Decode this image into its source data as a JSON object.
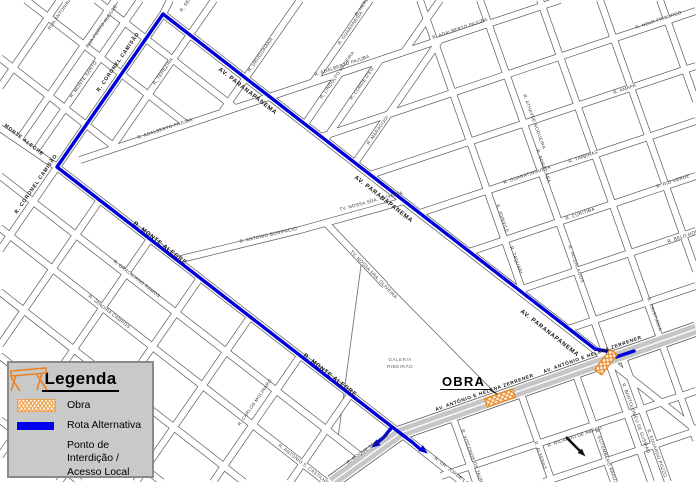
{
  "legend": {
    "title": "Legenda",
    "items": [
      {
        "id": "obra",
        "label": "Obra"
      },
      {
        "id": "rota",
        "label": "Rota Alternativa"
      },
      {
        "id": "ponto",
        "label": "Ponto de Interdição /",
        "label2": "Acesso Local"
      }
    ]
  },
  "map": {
    "colors": {
      "background": "#ffffff",
      "road_casing": "#5a5a5a",
      "road_fill": "#ffffff",
      "avenue_fill": "#c6c6c6",
      "route_blue": "#0000dd",
      "obra_orange": "#e8841f",
      "label_dark": "#3a3a3a",
      "label_main": "#111111",
      "creek_gray": "#777777"
    },
    "obra_callout": "OBRA",
    "galeria_label_line1": "GALERIA",
    "galeria_label_line2": "RIBEIRÃO",
    "roads": [
      {
        "name": "r-coronel-camisao",
        "pts": "170,0 163,14 57,167 0,250"
      },
      {
        "name": "av-paranapanema",
        "pts": "163,14 608,360 696,430"
      },
      {
        "name": "r-monte-alegre",
        "pts": "0,128 57,167 400,433 462,482"
      },
      {
        "name": "r-terezina",
        "pts": "214,0 110,150"
      },
      {
        "name": "r-adalberto-pajuba",
        "pts": "80,160 560,0"
      },
      {
        "name": "street",
        "pts": "115,0 20,138"
      },
      {
        "name": "street",
        "pts": "60,0 0,87"
      },
      {
        "name": "street",
        "pts": "140,0 36,150"
      },
      {
        "name": "street",
        "pts": "300,0 222,112"
      },
      {
        "name": "street",
        "pts": "370,0 313,82"
      },
      {
        "name": "street",
        "pts": "440,0 404,52"
      },
      {
        "name": "street",
        "pts": "340,73 305,124"
      },
      {
        "name": "street",
        "pts": "380,60 325,140"
      },
      {
        "name": "street",
        "pts": "440,40 355,163"
      },
      {
        "name": "street",
        "pts": "0,58 116,148"
      },
      {
        "name": "street",
        "pts": "26,0 186,124"
      },
      {
        "name": "street",
        "pts": "96,0 235,108"
      },
      {
        "name": "street",
        "pts": "177,260 300,230 404,201"
      },
      {
        "name": "street",
        "pts": "325,222 385,285"
      },
      {
        "name": "street",
        "pts": "0,176 363,458"
      },
      {
        "name": "street",
        "pts": "0,228 326,482"
      },
      {
        "name": "street",
        "pts": "0,292 244,482"
      },
      {
        "name": "street",
        "pts": "0,356 162,482"
      },
      {
        "name": "street",
        "pts": "0,420 80,482"
      },
      {
        "name": "street",
        "pts": "100,200 0,345"
      },
      {
        "name": "street",
        "pts": "150,239 0,456"
      },
      {
        "name": "street",
        "pts": "200,278 59,482"
      },
      {
        "name": "street",
        "pts": "250,317 136,482"
      },
      {
        "name": "street",
        "pts": "300,356 213,482"
      },
      {
        "name": "street",
        "pts": "350,395 290,482"
      },
      {
        "name": "street",
        "pts": "321,137 696,11"
      },
      {
        "name": "street",
        "pts": "370,175 696,66"
      },
      {
        "name": "street",
        "pts": "420,213 696,121"
      },
      {
        "name": "street",
        "pts": "469,252 696,176"
      },
      {
        "name": "street",
        "pts": "519,290 696,231"
      },
      {
        "name": "street",
        "pts": "568,329 696,286"
      },
      {
        "name": "street",
        "pts": "441,476 696,391"
      },
      {
        "name": "street",
        "pts": "544,482 696,431"
      },
      {
        "name": "street",
        "pts": "420,0 524,295"
      },
      {
        "name": "street",
        "pts": "480,0 608,360 651,482"
      },
      {
        "name": "street",
        "pts": "540,0 661,341 696,440"
      },
      {
        "name": "street",
        "pts": "600,0 696,271"
      },
      {
        "name": "street",
        "pts": "660,0 696,101"
      },
      {
        "name": "street",
        "pts": "520,391 552,482"
      },
      {
        "name": "street",
        "pts": "452,415 476,482"
      },
      {
        "name": "street",
        "pts": "575,372 614,482"
      },
      {
        "name": "street",
        "pts": "622,355 668,482"
      }
    ],
    "avenue": {
      "name": "av-antonio-e-helena-zerrener",
      "pts": "332,482 400,433 696,329"
    },
    "creeks": [
      "362,258 338,438",
      "362,258 500,398"
    ],
    "route": {
      "main": "634,351 616,357 606,351 595,349 163,14 57,167 400,433 412,442 420,449",
      "branch": "392,427 384,437 377,443",
      "arrows": [
        {
          "x": 427,
          "y": 453,
          "a": 38
        },
        {
          "x": 372,
          "y": 447,
          "a": 144
        }
      ]
    },
    "obra_zones": [
      {
        "cx": 500,
        "cy": 398,
        "w": 30,
        "h": 9,
        "a": -19.4
      },
      {
        "cx": 606,
        "cy": 362,
        "w": 9,
        "h": 26,
        "a": 37.8
      }
    ],
    "obra_callout_pos": {
      "x": 442,
      "y": 386,
      "underline": "440,389.5 490,389.5 497,394"
    },
    "galeria_pos": {
      "x": 400,
      "y": 361
    },
    "pointer": {
      "line": "566,437 581,452",
      "tip": {
        "x": 584,
        "y": 455,
        "a": 45
      }
    },
    "labels": [
      {
        "t": "RUA ANTONINA",
        "x": 50,
        "y": 30,
        "r": -55,
        "s": 4.6
      },
      {
        "t": "RUA PORTO ALEGRE",
        "x": 88,
        "y": 48,
        "r": -55,
        "s": 4.6
      },
      {
        "t": "R. MONTE SANTO",
        "x": 72,
        "y": 98,
        "r": -55,
        "s": 4.6
      },
      {
        "t": "R. TEREZINA",
        "x": 155,
        "y": 85,
        "r": -55,
        "s": 4.6
      },
      {
        "t": "R. SERGIPE",
        "x": 182,
        "y": 12,
        "r": -55,
        "s": 4.6
      },
      {
        "t": "R. GUARANESIA",
        "x": 340,
        "y": 45,
        "r": -55,
        "s": 4.6
      },
      {
        "t": "R. HERESINA",
        "x": 357,
        "y": 16,
        "r": -55,
        "s": 4.6
      },
      {
        "t": "R. URUGUAIANA",
        "x": 250,
        "y": 72,
        "r": -55,
        "s": 4.6
      },
      {
        "t": "R. LINDOLFO MADEIRA",
        "x": 322,
        "y": 99,
        "r": -55,
        "s": 4.6
      },
      {
        "t": "R. CONDE D'EU",
        "x": 352,
        "y": 100,
        "r": -55,
        "s": 4.6
      },
      {
        "t": "R. MARAGOGI",
        "x": 369,
        "y": 145,
        "r": -55,
        "s": 4.6
      },
      {
        "t": "R. ADALBERTO PAJUBA",
        "x": 138,
        "y": 139,
        "r": -18.5,
        "s": 4.6
      },
      {
        "t": "R. ADALBERTO PAJUBA",
        "x": 315,
        "y": 76,
        "r": -18.5,
        "s": 4.6
      },
      {
        "t": "R. ADALBERTO PAJUBA",
        "x": 433,
        "y": 39,
        "r": -18.5,
        "s": 4.6
      },
      {
        "t": "R. ANTONIO BONIFACIO",
        "x": 240,
        "y": 243,
        "r": -13,
        "s": 4.6
      },
      {
        "t": "TV. NOSSA SRA. OLIVEIRA",
        "x": 340,
        "y": 211,
        "r": -15,
        "s": 4.6
      },
      {
        "t": "TV. NOSSA SRA. OLIVEIRA",
        "x": 350,
        "y": 252,
        "r": 46,
        "s": 4.6
      },
      {
        "t": "R. GRACILIANO RAMOS",
        "x": 113,
        "y": 262,
        "r": 38,
        "s": 4.6
      },
      {
        "t": "R. JANDIRA CAMPOS",
        "x": 88,
        "y": 297,
        "r": 38,
        "s": 4.6
      },
      {
        "t": "R. ANTONIO S. CASTILHO",
        "x": 278,
        "y": 446,
        "r": 38,
        "s": 4.6
      },
      {
        "t": "R. CARLOS MOLINARO",
        "x": 240,
        "y": 426,
        "r": -55,
        "s": 4.6
      },
      {
        "t": "R. ROQUE TAGLIARI",
        "x": 348,
        "y": 464,
        "r": -35,
        "s": 4.6
      },
      {
        "t": "R. DR. JORGE LOBATO",
        "x": 434,
        "y": 459,
        "r": 38,
        "s": 4.6
      },
      {
        "t": "R. VISCONDE DE TAUNAY",
        "x": 461,
        "y": 430,
        "r": 70,
        "s": 4.6
      },
      {
        "t": "R. BARTOLOMEU DE GUSMAO",
        "x": 622,
        "y": 384,
        "r": 70,
        "s": 4.6
      },
      {
        "t": "R. GUTEMBERG ARAUJO",
        "x": 595,
        "y": 430,
        "r": 70,
        "s": 4.6
      },
      {
        "t": "R. EDUARDO POZZO",
        "x": 647,
        "y": 430,
        "r": 70,
        "s": 4.6
      },
      {
        "t": "R. ALFENAS",
        "x": 534,
        "y": 442,
        "r": 70,
        "s": 4.6
      },
      {
        "t": "R. RICARDO DE ABREU",
        "x": 548,
        "y": 447,
        "r": -18.5,
        "s": 4.6
      },
      {
        "t": "R. SOROCABA",
        "x": 536,
        "y": 150,
        "r": 70,
        "s": 4.6
      },
      {
        "t": "R. ATHAYDE NOGUEIRA",
        "x": 523,
        "y": 95,
        "r": 70,
        "s": 4.6
      },
      {
        "t": "R. AMAPA",
        "x": 614,
        "y": 94,
        "r": -18.5,
        "s": 4.6
      },
      {
        "t": "R. GUARATINGUETA",
        "x": 504,
        "y": 184,
        "r": -18.5,
        "s": 4.6
      },
      {
        "t": "R. JOINVILE",
        "x": 496,
        "y": 205,
        "r": 70,
        "s": 4.6
      },
      {
        "t": "R. CURITIBA",
        "x": 566,
        "y": 220,
        "r": -18.5,
        "s": 4.6
      },
      {
        "t": "R. TAQUARI",
        "x": 510,
        "y": 247,
        "r": 70,
        "s": 4.6
      },
      {
        "t": "R. INTERLAGOS",
        "x": 568,
        "y": 246,
        "r": 70,
        "s": 4.6
      },
      {
        "t": "R. RIO VERDE",
        "x": 657,
        "y": 188,
        "r": -18.5,
        "s": 4.6
      },
      {
        "t": "R. CRISTIANIA",
        "x": 647,
        "y": 298,
        "r": 70,
        "s": 4.6
      },
      {
        "t": "R. BELO HORIZONTE",
        "x": 668,
        "y": 243,
        "r": -18.5,
        "s": 4.6
      },
      {
        "t": "R. TIMBIRAS",
        "x": 569,
        "y": 163,
        "r": -18.5,
        "s": 4.6
      },
      {
        "t": "R. NOVA FRIBURGO",
        "x": 636,
        "y": 29,
        "r": -18.5,
        "s": 4.6
      },
      {
        "t": "AV. PARANAPANEMA",
        "x": 218,
        "y": 70,
        "r": 38,
        "s": 6,
        "m": 1
      },
      {
        "t": "AV. PARANAPANEMA",
        "x": 354,
        "y": 178,
        "r": 38,
        "s": 6,
        "m": 1
      },
      {
        "t": "AV. PARANAPANEMA",
        "x": 520,
        "y": 312,
        "r": 38,
        "s": 6,
        "m": 1
      },
      {
        "t": "R. MONTE ALEGRE",
        "x": 133,
        "y": 224,
        "r": 38,
        "s": 6,
        "m": 1
      },
      {
        "t": "R. MONTE ALEGRE",
        "x": 303,
        "y": 356,
        "r": 38,
        "s": 6,
        "m": 1
      },
      {
        "t": "MONTE ALEGRE",
        "x": 4,
        "y": 126,
        "r": 38,
        "s": 5,
        "m": 1
      },
      {
        "t": "R. CORONEL CAMISÃO",
        "x": 99,
        "y": 92,
        "r": -55.3,
        "s": 5.2,
        "m": 1
      },
      {
        "t": "R. CORONEL CAMISÃO",
        "x": 17,
        "y": 214,
        "r": -55.3,
        "s": 5.2,
        "m": 1
      },
      {
        "t": "AV. ANTÔNIO E HELENA ZERRENER",
        "x": 436,
        "y": 411,
        "r": -19.4,
        "s": 4.8,
        "m": 1
      },
      {
        "t": "AV. ANTÔNIO E HELENA ZERRENER",
        "x": 544,
        "y": 373,
        "r": -19.4,
        "s": 4.8,
        "m": 1
      }
    ]
  }
}
